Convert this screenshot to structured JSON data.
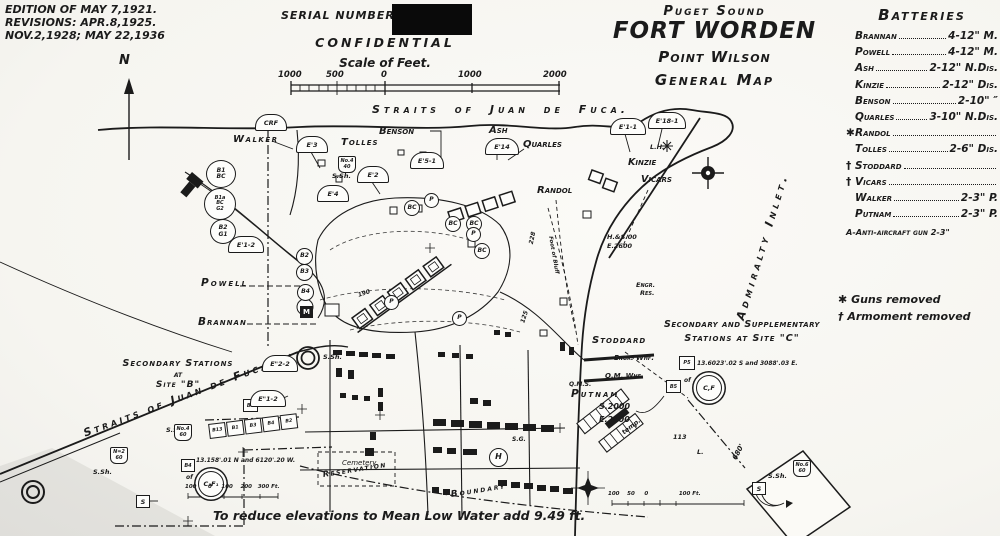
{
  "edition": {
    "line1": "EDITION OF MAY 7,1921.",
    "line2": "REVISIONS: APR.8,1925.",
    "line3": "NOV.2,1928; MAY 22,1936"
  },
  "north_label": "N",
  "serial_label": "SERIAL NUMBER",
  "confidential": "CONFIDENTIAL",
  "scale": {
    "title": "Scale of Feet.",
    "tick1": "1000",
    "tick2": "500",
    "tick3": "0",
    "tick4": "1000",
    "tick5": "2000"
  },
  "title_block": {
    "region": "Puget Sound",
    "fort": "FORT WORDEN",
    "point": "Point Wilson",
    "map_type": "General Map"
  },
  "batteries_panel": {
    "title": "Batteries",
    "items": [
      {
        "marker": "",
        "name": "Brannan",
        "armament": "4-12\" M."
      },
      {
        "marker": "",
        "name": "Powell",
        "armament": "4-12\" M."
      },
      {
        "marker": "",
        "name": "Ash",
        "armament": "2-12\" N.Dis."
      },
      {
        "marker": "",
        "name": "Kinzie",
        "armament": "2-12\" Dis."
      },
      {
        "marker": "",
        "name": "Benson",
        "armament": "2-10\"  ″"
      },
      {
        "marker": "",
        "name": "Quarles",
        "armament": "3-10\" N.Dis."
      },
      {
        "marker": "✱",
        "name": "Randol",
        "armament": ""
      },
      {
        "marker": "",
        "name": "Tolles",
        "armament": "2-6\" Dis."
      },
      {
        "marker": "†",
        "name": "Stoddard",
        "armament": ""
      },
      {
        "marker": "†",
        "name": "Vicars",
        "armament": ""
      },
      {
        "marker": "",
        "name": "Walker",
        "armament": "2-3\" P."
      },
      {
        "marker": "",
        "name": "Putnam",
        "armament": "2-3\" P."
      }
    ],
    "aa_note": "A-Anti-aircraft gun 2-3\""
  },
  "legend": {
    "guns_symbol": "✱",
    "guns_text": "Guns removed",
    "armament_symbol": "†",
    "armament_text": "Armoment removed"
  },
  "map": {
    "water": {
      "straits_top": "Straits of Juan de Fuca.",
      "straits_diag": "Straits of Juan de Fuca.",
      "admiralty": "Admiralty  Inlet."
    },
    "batteries": {
      "walker": "Walker",
      "benson": "Benson",
      "tolles": "Tolles",
      "ash": "Ash",
      "quarles": "Quarles",
      "kinzie": "Kinzie",
      "vicars": "Vicars",
      "randol": "Randol",
      "powell": "Powell",
      "brannan": "Brannan",
      "stoddard": "Stoddard",
      "putnam": "Putnam"
    },
    "places": {
      "engr_whf": "Engr. Whf.",
      "qm_whf": "Q.M. Whf.",
      "qms": "Q.M.S.",
      "engr_res1": "Engr.",
      "engr_res2": "Res.",
      "lh": "L.H.",
      "cemetery1": "Cemetery",
      "cemetery2": "Reservation",
      "boundary": "Boundary",
      "sg": "S.G.",
      "h": "H",
      "temp": "temp.",
      "n113": "113",
      "l_dot": "L.",
      "d680": "680'"
    },
    "site_b": {
      "l1": "Secondary Stations",
      "l2": "at",
      "l3": "Site \"B\"",
      "coords": "13.158'.01 N and 6120'.20 W.",
      "of": "of",
      "circle": "C₁F₁"
    },
    "site_c": {
      "l1": "Secondary and Supplementary",
      "l2": "Stations at Site \"C\"",
      "coords": "13.6023'.02 S and 3088'.03 E.",
      "of": "of",
      "circle": "C,F",
      "sq1": "P5",
      "sq2": "B5"
    },
    "coords": {
      "s2000": "S.2000",
      "e2000": "E.2000",
      "hs00": "H.&S.00",
      "e2600": "E.2600"
    },
    "notes": {
      "reduce": "To reduce elevations to Mean Low Water add 9.49 ft."
    },
    "s_sh": "S.Sh.",
    "contours": {
      "c190": "190",
      "c200": "200",
      "c125": "125",
      "c228": "228",
      "bluff": "Foot of Bluff"
    },
    "mini_scale_b": "100      0     100    200   300 Ft.",
    "mini_scale_c": "100    50     0                100 Ft.",
    "stations": {
      "crf": "CRF",
      "e3": "E'3",
      "e2": "E'2",
      "e51": "E'5-1",
      "e4": "E'4",
      "e14": "E'14",
      "e11": "E'1-1",
      "e181": "E'18-1",
      "e12": "E'1-2",
      "eb22": "E\"2-2",
      "eb12": "E\"1-2"
    },
    "circles": {
      "c1a": "B1",
      "c1b": "BC",
      "big0": "B1a",
      "big1": "BC",
      "big2": "G2",
      "c3a": "B2",
      "c3b": "G1",
      "b2": "B2",
      "b3": "B3",
      "b4": "B4",
      "bc": "BC",
      "p": "P"
    },
    "shields": {
      "no4": "No.4",
      "no6": "No.6",
      "n2": "N=2",
      "v40": "40",
      "v60": "60"
    },
    "sbox": "S",
    "m_sq": "M",
    "siteb_row": [
      "B13",
      "B1",
      "B3",
      "B4",
      "B2"
    ],
    "siteb_sq": "B4"
  }
}
